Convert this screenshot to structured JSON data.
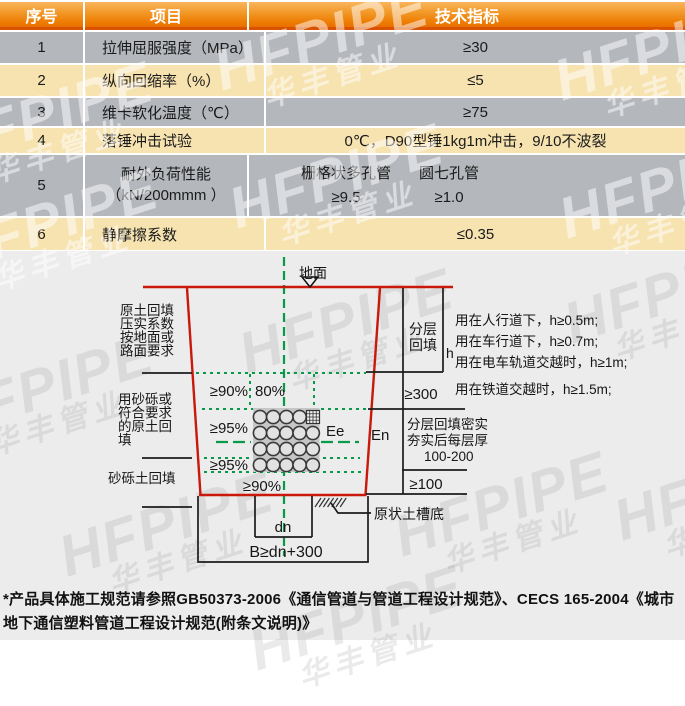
{
  "table": {
    "headers": {
      "seq": "序号",
      "item": "项目",
      "spec": "技术指标"
    },
    "rows": [
      {
        "seq": "1",
        "item": "拉伸屈服强度（MPa）",
        "spec": "≥30"
      },
      {
        "seq": "2",
        "item": "纵向回缩率（%）",
        "spec": "≤5"
      },
      {
        "seq": "3",
        "item": "维卡软化温度（℃）",
        "spec": "≥75"
      },
      {
        "seq": "4",
        "item": "落锤冲击试验",
        "spec": "0℃，D90型锤1kg1m冲击，9/10不波裂"
      },
      {
        "seq": "5",
        "item_line1": "耐外负荷性能",
        "item_line2": "（kN/200mmm ）",
        "spec_col1_header": "栅格状多孔管",
        "spec_col1_value": "≥9.5",
        "spec_col2_header": "圆七孔管",
        "spec_col2_value": "≥1.0"
      },
      {
        "seq": "6",
        "item": "静摩擦系数",
        "spec": "≤0.35"
      }
    ]
  },
  "diagram": {
    "ground": "地面",
    "note_fill_top": [
      "原土回填",
      "压实系数",
      "按地面或",
      "路面要求"
    ],
    "note_fill_mid": [
      "用砂砾或",
      "符合要求",
      "的原土回",
      "填"
    ],
    "note_fill_bottom": "砂砾土回填",
    "pct_top": "≥90%",
    "pct_80": "80%",
    "pct_95a": "≥95%",
    "pct_95b": "≥95%",
    "pct_bottom": "≥90%",
    "label_ee": "Ee",
    "label_en": "En",
    "label_h": "h",
    "layered_1": "分层",
    "layered_2": "回填",
    "dim300": "≥300",
    "compact_1": "分层回填密实",
    "compact_2": "夯实后每层厚",
    "compact_3": "100-200",
    "dim100": "≥100",
    "undisturbed": "原状土槽底",
    "dn": "dn",
    "b_formula": "B≥dn+300",
    "use_1": "用在人行道下，h≥0.5m;",
    "use_2": "用在车行道下，h≥0.7m;",
    "use_3": "用在电车轨道交越时，h≥1m;",
    "use_4": "用在铁道交越时，h≥1.5m;"
  },
  "watermark": {
    "en": "HFPIPE",
    "cn": "华丰管业"
  },
  "footnote": "*产品具体施工规范请参照GB50373-2006《通信管道与管道工程设计规范》、CECS 165-2004《城市地下通信塑料管道工程设计规范(附条文说明)》",
  "colors": {
    "header_orange_top": "#fab55e",
    "header_orange_bottom": "#e96f00",
    "header_border": "#d85200",
    "row_gray": "#b4b7bc",
    "row_cream": "#f7e3b0",
    "trench_red": "#c8190b",
    "dashed_green": "#069a49",
    "lower_background": "#ececec"
  }
}
